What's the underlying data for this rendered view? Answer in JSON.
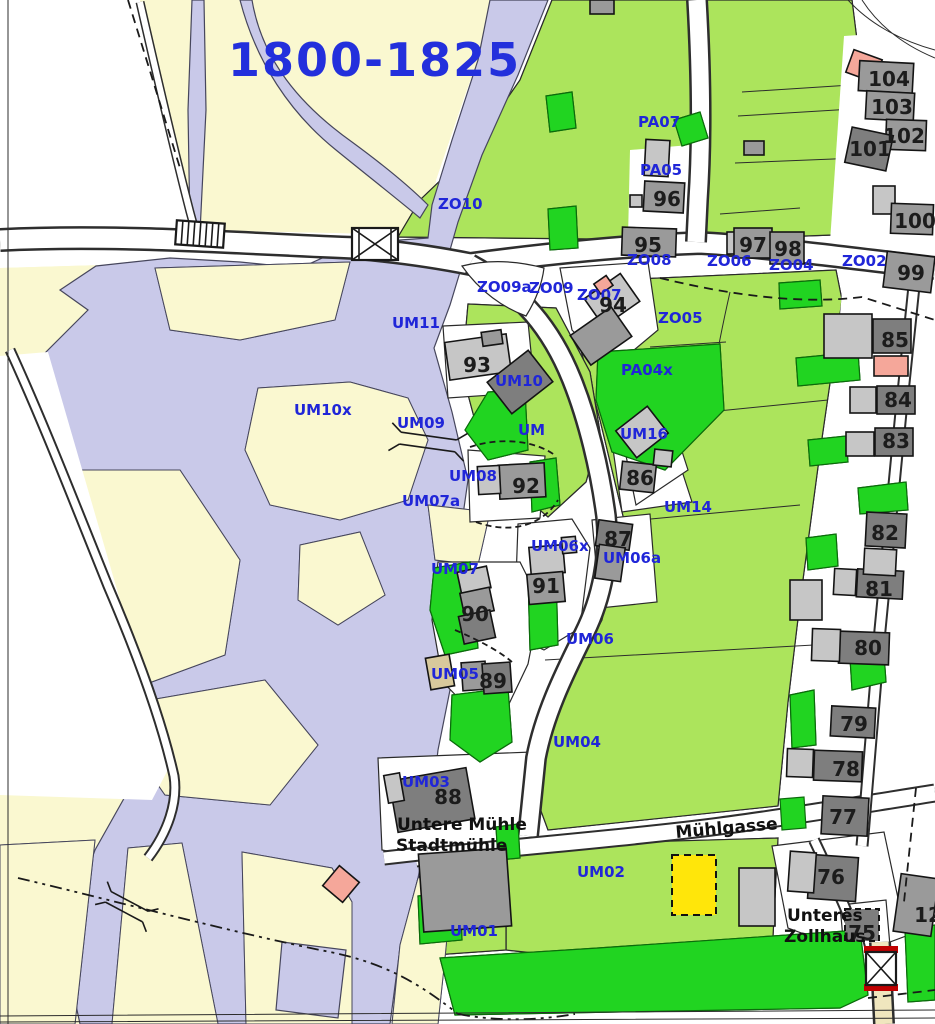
{
  "title": {
    "text": "1800-1825"
  },
  "palette": {
    "meadow": "#FAF8D0",
    "water": "#C9C9E9",
    "orchard": "#ACE45C",
    "garden_green": "#21D421",
    "building_gray": "#9A9A9A",
    "building_dark": "#7E7E7E",
    "building_light": "#C6C6C6",
    "building_salmon": "#F5A79A",
    "highlight_yellow": "#FFE60A",
    "label_blue": "#2026D8",
    "road_white": "#FFFFFF",
    "road_tan": "#F0E6BE",
    "bridge_red": "#C00000"
  },
  "parcel_labels": [
    {
      "text": "PA07",
      "x": 638,
      "y": 127
    },
    {
      "text": "PA05",
      "x": 640,
      "y": 175
    },
    {
      "text": "ZO10",
      "x": 438,
      "y": 209
    },
    {
      "text": "ZO08",
      "x": 627,
      "y": 265
    },
    {
      "text": "ZO06",
      "x": 707,
      "y": 266
    },
    {
      "text": "ZO04",
      "x": 769,
      "y": 270
    },
    {
      "text": "ZO02",
      "x": 842,
      "y": 266
    },
    {
      "text": "ZO09a",
      "x": 477,
      "y": 292
    },
    {
      "text": "ZO09",
      "x": 529,
      "y": 293
    },
    {
      "text": "ZO07",
      "x": 577,
      "y": 300
    },
    {
      "text": "ZO05",
      "x": 658,
      "y": 323
    },
    {
      "text": "UM11",
      "x": 392,
      "y": 328
    },
    {
      "text": "UM10",
      "x": 495,
      "y": 386
    },
    {
      "text": "PA04x",
      "x": 621,
      "y": 375
    },
    {
      "text": "UM10x",
      "x": 294,
      "y": 415
    },
    {
      "text": "UM09",
      "x": 397,
      "y": 428
    },
    {
      "text": "UM",
      "x": 518,
      "y": 435
    },
    {
      "text": "UM16",
      "x": 620,
      "y": 439
    },
    {
      "text": "UM08",
      "x": 449,
      "y": 481
    },
    {
      "text": "UM07a",
      "x": 402,
      "y": 506
    },
    {
      "text": "UM14",
      "x": 664,
      "y": 512
    },
    {
      "text": "UM06x",
      "x": 531,
      "y": 551
    },
    {
      "text": "UM06a",
      "x": 603,
      "y": 563
    },
    {
      "text": "UM07",
      "x": 431,
      "y": 574
    },
    {
      "text": "UM06",
      "x": 566,
      "y": 644
    },
    {
      "text": "UM05",
      "x": 431,
      "y": 679
    },
    {
      "text": "UM04",
      "x": 553,
      "y": 747
    },
    {
      "text": "UM03",
      "x": 402,
      "y": 787
    },
    {
      "text": "UM02",
      "x": 577,
      "y": 877
    },
    {
      "text": "UM01",
      "x": 450,
      "y": 936
    }
  ],
  "building_numbers": [
    {
      "text": "104",
      "x": 889,
      "y": 86
    },
    {
      "text": "103",
      "x": 892,
      "y": 114
    },
    {
      "text": "102",
      "x": 904,
      "y": 143
    },
    {
      "text": "101",
      "x": 870,
      "y": 156
    },
    {
      "text": "96",
      "x": 667,
      "y": 206
    },
    {
      "text": "100",
      "x": 915,
      "y": 228
    },
    {
      "text": "95",
      "x": 648,
      "y": 252
    },
    {
      "text": "97",
      "x": 753,
      "y": 252
    },
    {
      "text": "98",
      "x": 788,
      "y": 256
    },
    {
      "text": "99",
      "x": 911,
      "y": 280
    },
    {
      "text": "94",
      "x": 613,
      "y": 312
    },
    {
      "text": "85",
      "x": 895,
      "y": 347
    },
    {
      "text": "93",
      "x": 477,
      "y": 372
    },
    {
      "text": "84",
      "x": 898,
      "y": 407
    },
    {
      "text": "83",
      "x": 896,
      "y": 448
    },
    {
      "text": "86",
      "x": 640,
      "y": 485
    },
    {
      "text": "92",
      "x": 526,
      "y": 493
    },
    {
      "text": "82",
      "x": 885,
      "y": 540
    },
    {
      "text": "87",
      "x": 618,
      "y": 546
    },
    {
      "text": "81",
      "x": 879,
      "y": 596
    },
    {
      "text": "91",
      "x": 546,
      "y": 593
    },
    {
      "text": "90",
      "x": 475,
      "y": 621
    },
    {
      "text": "80",
      "x": 868,
      "y": 655
    },
    {
      "text": "89",
      "x": 493,
      "y": 688
    },
    {
      "text": "79",
      "x": 854,
      "y": 731
    },
    {
      "text": "78",
      "x": 846,
      "y": 776
    },
    {
      "text": "77",
      "x": 843,
      "y": 824
    },
    {
      "text": "88",
      "x": 448,
      "y": 804
    },
    {
      "text": "76",
      "x": 831,
      "y": 884
    },
    {
      "text": "75",
      "x": 862,
      "y": 940
    },
    {
      "text": "12",
      "x": 928,
      "y": 922
    }
  ],
  "place_names": [
    {
      "text": "Untere Mühle",
      "x": 397,
      "y": 830
    },
    {
      "text": "Stadtmühle",
      "x": 396,
      "y": 851
    },
    {
      "text": "Mühlgasse",
      "x": 676,
      "y": 838,
      "rotation": -5
    },
    {
      "text": "Unteres",
      "x": 787,
      "y": 921
    },
    {
      "text": "Zollhaus",
      "x": 784,
      "y": 942
    }
  ]
}
